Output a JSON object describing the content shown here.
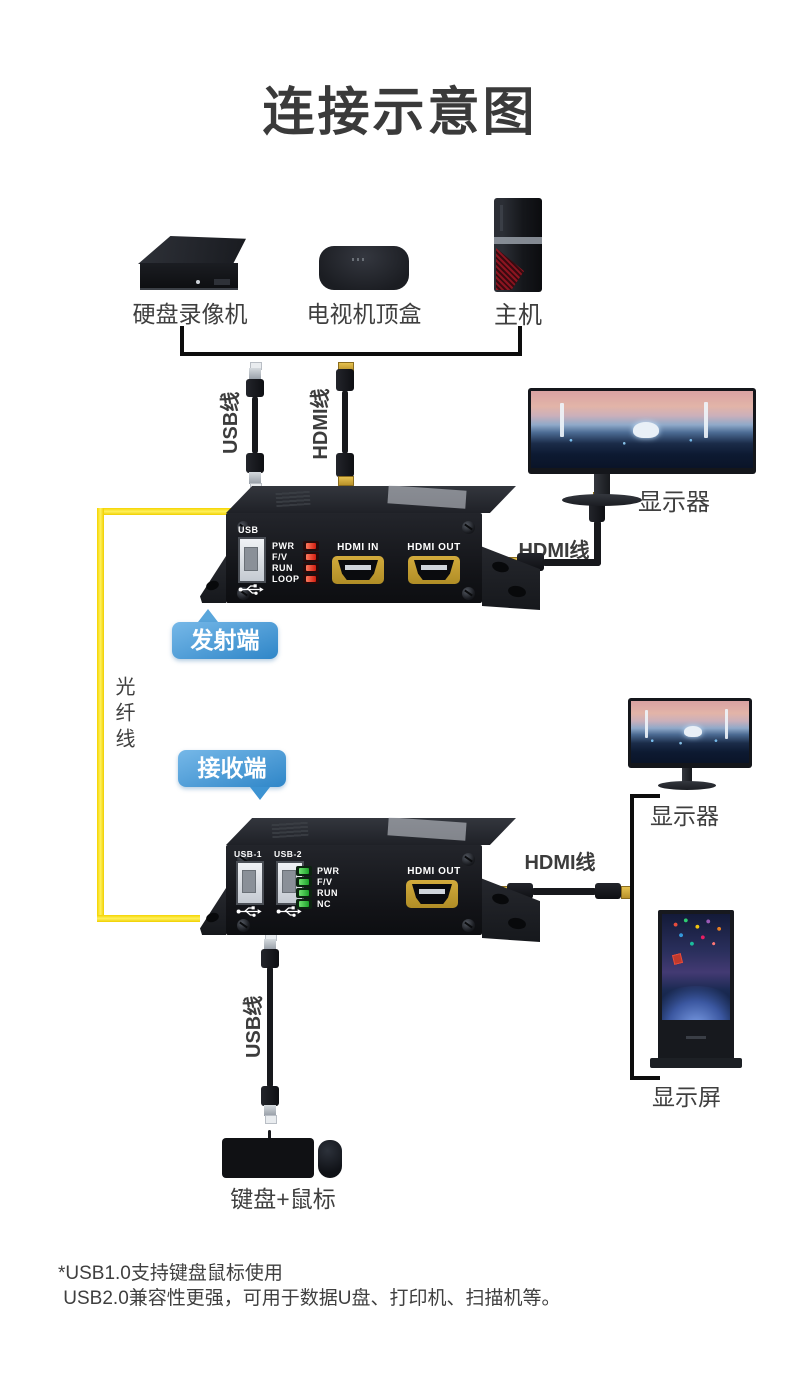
{
  "title": "连接示意图",
  "sources": {
    "dvr": "硬盘录像机",
    "stb": "电视机顶盒",
    "host": "主机"
  },
  "cables": {
    "usb_top": "USB线",
    "hdmi_top": "HDMI线",
    "hdmi_tx": "HDMI线",
    "fiber": "光纤线",
    "hdmi_rx": "HDMI线",
    "usb_bottom": "USB线"
  },
  "badges": {
    "tx": "发射端",
    "rx": "接收端"
  },
  "tx": {
    "usb_label": "USB",
    "leds": [
      "PWR",
      "F/V",
      "RUN",
      "LOOP"
    ],
    "ports": [
      "HDMI IN",
      "HDMI OUT"
    ]
  },
  "rx": {
    "usb_labels": [
      "USB-1",
      "USB-2"
    ],
    "leds": [
      "PWR",
      "F/V",
      "RUN",
      "NC"
    ],
    "port": "HDMI OUT"
  },
  "displays": {
    "monitor_top": "显示器",
    "monitor_mid": "显示器",
    "signage": "显示屏"
  },
  "peripherals": {
    "kbm": "键盘+鼠标"
  },
  "footnote": {
    "line1": "*USB1.0支持键盘鼠标使用",
    "line2": " USB2.0兼容性更强，可用于数据U盘、打印机、扫描机等。"
  },
  "colors": {
    "badge_blue": "#3f96d6",
    "fiber_yellow": "#ffe70a",
    "led_red": "#e02d1c",
    "led_green": "#2fb53a",
    "text_dark": "#3f3f3f"
  }
}
